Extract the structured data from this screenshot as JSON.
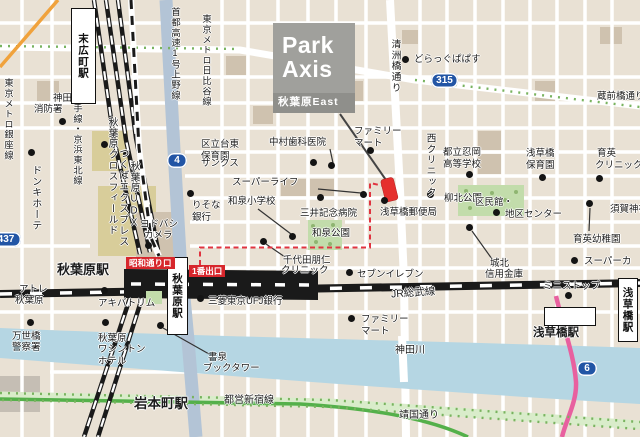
{
  "logo": {
    "line1": "Park",
    "line2": "Axis",
    "subtitle": "秋葉原East"
  },
  "colors": {
    "block": "#e9e1d4",
    "street": "#ffffff",
    "water": "#b5d6e3",
    "park": "#c2dcab",
    "tree_green": "#79b35f",
    "highway_blue": "#b3c4d6",
    "rail_black": "#1a1a1a",
    "subway_green": "#54b04a",
    "road_pink": "#e8609f",
    "route_red": "#e03440",
    "marker_red": "#e5302e",
    "shield_blue": "#2255a5",
    "badge_red": "#d7262c",
    "logo_bg": "#a0a09c",
    "logo_sub_bg": "#8f8f8b",
    "ginza_orange": "#f0a23c"
  },
  "labels": [
    {
      "t": "神田",
      "x": 53,
      "y": 93
    },
    {
      "t": "消防署",
      "x": 34,
      "y": 104
    },
    {
      "t": "区立台東",
      "x": 201,
      "y": 139
    },
    {
      "t": "保育園",
      "x": 201,
      "y": 151
    },
    {
      "t": "中村歯科医院",
      "x": 269,
      "y": 137
    },
    {
      "t": "サンクス",
      "x": 201,
      "y": 158
    },
    {
      "t": "スーパーライフ",
      "x": 232,
      "y": 177
    },
    {
      "t": "和泉小学校",
      "x": 228,
      "y": 196
    },
    {
      "t": "三井記念病院",
      "x": 300,
      "y": 208
    },
    {
      "t": "和泉公園",
      "x": 312,
      "y": 228
    },
    {
      "t": "千代田朋仁",
      "x": 283,
      "y": 255
    },
    {
      "t": "クリニック",
      "x": 281,
      "y": 265
    },
    {
      "t": "セブンイレブン",
      "x": 357,
      "y": 269
    },
    {
      "t": "ファミリー",
      "x": 354,
      "y": 126
    },
    {
      "t": "マート",
      "x": 354,
      "y": 138
    },
    {
      "t": "どらっぐぱぱす",
      "x": 414,
      "y": 54
    },
    {
      "t": "蔵前橋通り",
      "x": 597,
      "y": 91
    },
    {
      "t": "都立忍岡",
      "x": 443,
      "y": 147
    },
    {
      "t": "高等学校",
      "x": 443,
      "y": 159
    },
    {
      "t": "浅草橋",
      "x": 526,
      "y": 148
    },
    {
      "t": "保育園",
      "x": 526,
      "y": 160
    },
    {
      "t": "育英",
      "x": 597,
      "y": 148
    },
    {
      "t": "クリニック",
      "x": 595,
      "y": 160
    },
    {
      "t": "柳北公園",
      "x": 444,
      "y": 193
    },
    {
      "t": "区民館・",
      "x": 475,
      "y": 197
    },
    {
      "t": "地区センター",
      "x": 505,
      "y": 209
    },
    {
      "t": "須賀神社",
      "x": 610,
      "y": 204
    },
    {
      "t": "育英幼稚園",
      "x": 573,
      "y": 234
    },
    {
      "t": "城北",
      "x": 490,
      "y": 258
    },
    {
      "t": "信用金庫",
      "x": 485,
      "y": 269
    },
    {
      "t": "スーパーカ",
      "x": 584,
      "y": 256
    },
    {
      "t": "ミニストップ",
      "x": 543,
      "y": 281
    },
    {
      "t": "浅草橋駅",
      "x": 533,
      "y": 327,
      "fs": 11.5,
      "b": 1
    },
    {
      "t": "神田川",
      "x": 395,
      "y": 345,
      "fs": 10
    },
    {
      "t": "JR総武線",
      "x": 391,
      "y": 287,
      "fs": 10.5,
      "r": -4
    },
    {
      "t": "ファミリー",
      "x": 361,
      "y": 314
    },
    {
      "t": "マート",
      "x": 361,
      "y": 326
    },
    {
      "t": "三菱東京UFJ銀行",
      "x": 208,
      "y": 296
    },
    {
      "t": "書泉",
      "x": 208,
      "y": 352
    },
    {
      "t": "ブックタワー",
      "x": 203,
      "y": 363
    },
    {
      "t": "都営新宿線",
      "x": 224,
      "y": 395,
      "fs": 10
    },
    {
      "t": "靖国通り",
      "x": 399,
      "y": 410,
      "fs": 10
    },
    {
      "t": "岩本町駅",
      "x": 134,
      "y": 396,
      "fs": 13.5,
      "b": 1
    },
    {
      "t": "秋葉原駅",
      "x": 57,
      "y": 262,
      "fs": 13,
      "b": 1
    },
    {
      "t": "秋葉原",
      "x": 98,
      "y": 333
    },
    {
      "t": "ワシントン",
      "x": 98,
      "y": 344
    },
    {
      "t": "ホテル",
      "x": 98,
      "y": 356
    },
    {
      "t": "アキバトリム",
      "x": 98,
      "y": 298
    },
    {
      "t": "アトレ",
      "x": 19,
      "y": 284
    },
    {
      "t": "秋葉原",
      "x": 15,
      "y": 295
    },
    {
      "t": "万世橋",
      "x": 12,
      "y": 331
    },
    {
      "t": "警察署",
      "x": 12,
      "y": 342
    },
    {
      "t": "ヨドバシ",
      "x": 140,
      "y": 219
    },
    {
      "t": "カメラ",
      "x": 144,
      "y": 230
    },
    {
      "t": "りそな",
      "x": 192,
      "y": 200
    },
    {
      "t": "銀行",
      "x": 192,
      "y": 212
    },
    {
      "t": "浅草橋郵便局",
      "x": 380,
      "y": 207
    },
    {
      "t": "東京メトロ銀座線",
      "x": 2,
      "y": 78,
      "v": 1,
      "fs": 9.3
    },
    {
      "t": "山手線・京浜東北線",
      "x": 71,
      "y": 93,
      "v": 1,
      "fs": 9.3
    },
    {
      "t": "秋葉原クロスフィールド",
      "x": 106,
      "y": 117,
      "v": 1,
      "fs": 9.8
    },
    {
      "t": "秋葉原UDX",
      "x": 128,
      "y": 161,
      "v": 1,
      "fs": 9.8
    },
    {
      "t": "ドンキホーテ",
      "x": 29,
      "y": 165,
      "v": 1,
      "fs": 10
    },
    {
      "t": "つくばエクスプレス",
      "x": 116,
      "y": 148,
      "v": 1,
      "fs": 10
    },
    {
      "t": "首都高速1号上野線",
      "x": 169,
      "y": 7,
      "v": 1,
      "fs": 9.3
    },
    {
      "t": "東京メトロ日比谷線",
      "x": 200,
      "y": 14,
      "v": 1,
      "fs": 9.3
    },
    {
      "t": "清洲橋通り",
      "x": 389,
      "y": 39,
      "v": 1,
      "fs": 9.8
    },
    {
      "t": "西クリニック",
      "x": 424,
      "y": 133,
      "v": 1,
      "fs": 9.8
    }
  ],
  "dots": [
    [
      62,
      121
    ],
    [
      313,
      162
    ],
    [
      331,
      165
    ],
    [
      363,
      194
    ],
    [
      292,
      236
    ],
    [
      320,
      197
    ],
    [
      263,
      241
    ],
    [
      349,
      272
    ],
    [
      370,
      150
    ],
    [
      430,
      194
    ],
    [
      384,
      200
    ],
    [
      405,
      59
    ],
    [
      469,
      174
    ],
    [
      542,
      177
    ],
    [
      599,
      178
    ],
    [
      496,
      212
    ],
    [
      589,
      203
    ],
    [
      469,
      227
    ],
    [
      574,
      260
    ],
    [
      568,
      295
    ],
    [
      351,
      318
    ],
    [
      200,
      298
    ],
    [
      160,
      325
    ],
    [
      30,
      322
    ],
    [
      104,
      290
    ],
    [
      105,
      322
    ],
    [
      148,
      245
    ],
    [
      190,
      193
    ],
    [
      31,
      152
    ],
    [
      104,
      144
    ],
    [
      126,
      153
    ]
  ],
  "route_shields": [
    {
      "t": "4",
      "x": 167,
      "y": 153,
      "w": 20
    },
    {
      "t": "315",
      "x": 431,
      "y": 73,
      "w": 27
    },
    {
      "t": "437",
      "x": -9,
      "y": 232,
      "w": 30
    },
    {
      "t": "6",
      "x": 577,
      "y": 361,
      "w": 20
    }
  ],
  "exit_badges": [
    {
      "t": "昭和通り口",
      "x": 126,
      "y": 257
    },
    {
      "t": "1番出口",
      "x": 189,
      "y": 265
    }
  ],
  "station_boxes": [
    {
      "t": "末広町駅",
      "x": 71,
      "y": 8,
      "w": 25,
      "h": 96,
      "v": 1
    },
    {
      "t": "秋葉原駅",
      "x": 167,
      "y": 257,
      "w": 21,
      "h": 78,
      "v": 1
    },
    {
      "t": "浅草橋駅",
      "x": 618,
      "y": 278,
      "w": 20,
      "h": 64,
      "v": 1
    },
    {
      "t": "",
      "x": 544,
      "y": 307,
      "w": 52,
      "h": 19,
      "v": 0
    }
  ]
}
